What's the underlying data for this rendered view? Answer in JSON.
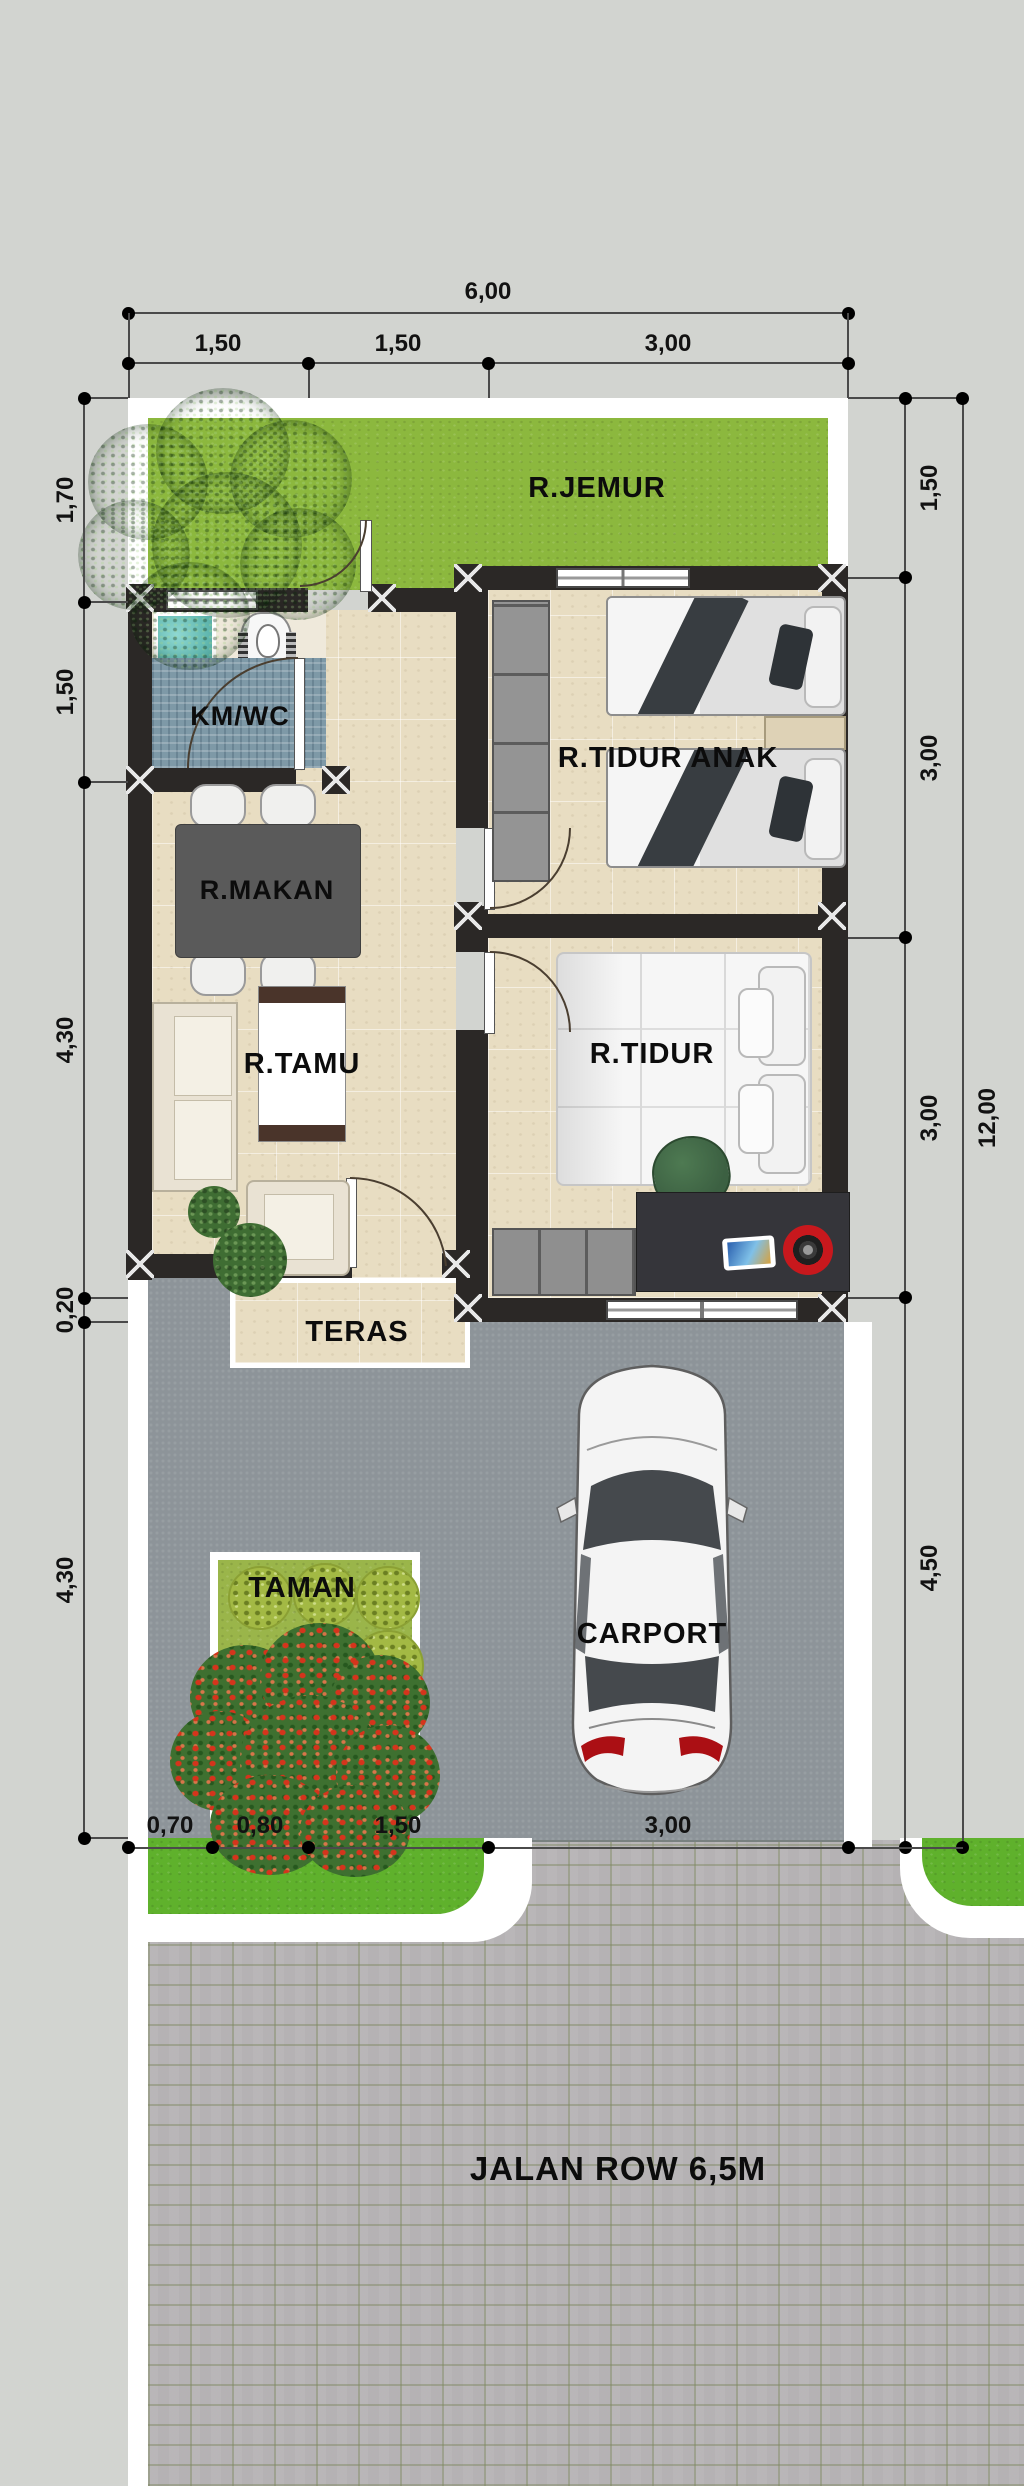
{
  "rooms": {
    "jemur": "R.JEMUR",
    "kmwc": "KM/WC",
    "makan": "R.MAKAN",
    "tamu": "R.TAMU",
    "tidur_anak": "R.TIDUR ANAK",
    "tidur": "R.TIDUR",
    "teras": "TERAS",
    "taman": "TAMAN",
    "carport": "CARPORT"
  },
  "road": {
    "label": "JALAN ROW 6,5M"
  },
  "dims": {
    "top_total": "6,00",
    "top_segments": [
      "1,50",
      "1,50",
      "3,00"
    ],
    "left": [
      "1,70",
      "1,50",
      "4,30",
      "0,20",
      "4,30"
    ],
    "right": [
      "1,50",
      "3,00",
      "3,00",
      "4,50"
    ],
    "right_total": "12,00",
    "bottom": [
      "0,70",
      "0,80",
      "1,50",
      "3,00"
    ]
  },
  "colors": {
    "background": "#d2d4d0",
    "wall": "#2b2826",
    "grass_jemur": "#8cb83e",
    "grass_verge": "#5fb12c",
    "grass_taman": "#9ab54a",
    "floor_tile": "#e8ddc2",
    "mosaic_floor": "#7e99a7",
    "bak_mandi": "#63b9b1",
    "carport_slab": "#8d9499",
    "road_paver": "#b5b2b4",
    "curb": "#ffffff",
    "accent_red": "#c8181d"
  }
}
